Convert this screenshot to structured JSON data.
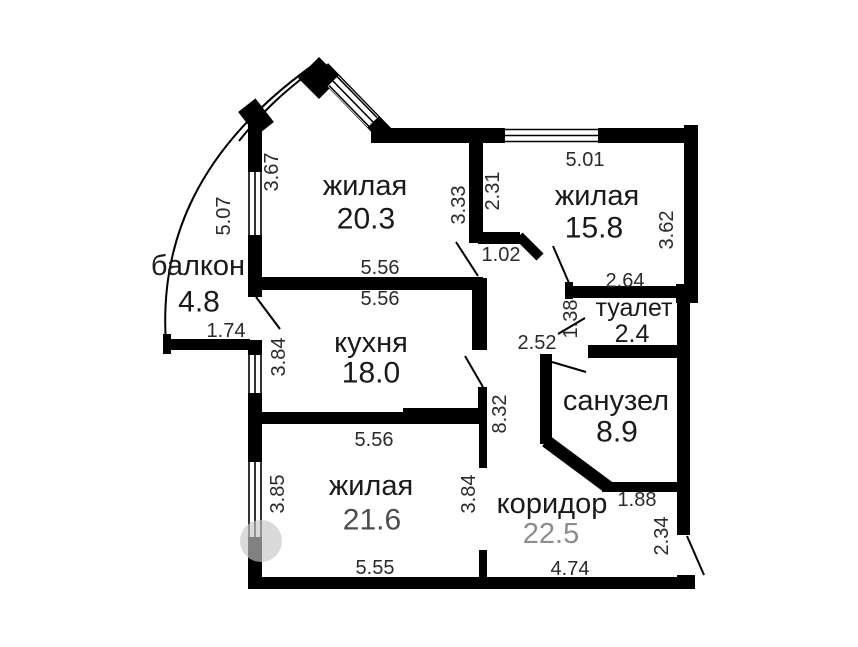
{
  "floorplan": {
    "type": "apartment-floor-plan",
    "rooms": {
      "balcony": {
        "name": "балкон",
        "area": "4.8"
      },
      "living1": {
        "name": "жилая",
        "area": "20.3"
      },
      "living2": {
        "name": "жилая",
        "area": "15.8"
      },
      "kitchen": {
        "name": "кухня",
        "area": "18.0"
      },
      "living3": {
        "name": "жилая",
        "area": "21.6"
      },
      "toilet": {
        "name": "туалет",
        "area": "2.4"
      },
      "bathroom": {
        "name": "санузел",
        "area": "8.9"
      },
      "corridor": {
        "name": "коридор",
        "area": "22.5"
      }
    },
    "dimensions": {
      "living1_left_upper": "3.67",
      "balcony_window": "5.07",
      "balcony_width": "1.74",
      "living1_bottom": "5.56",
      "kitchen_top": "5.56",
      "living3_top": "5.56",
      "living3_bottom": "5.55",
      "kitchen_left": "3.84",
      "living3_left": "3.85",
      "living1_right": "3.33",
      "living2_left": "2.31",
      "living2_top": "5.01",
      "living2_right": "3.62",
      "living2_entry": "1.02",
      "living2_bottom": "2.64",
      "toilet_left": "1.38",
      "corridor_upper": "2.52",
      "corridor_height": "8.32",
      "living3_right": "3.84",
      "bathroom_bottom": "1.88",
      "entrance_wall": "2.34",
      "corridor_bottom": "4.74"
    },
    "wall_color": "#000000",
    "background_color": "#ffffff"
  }
}
